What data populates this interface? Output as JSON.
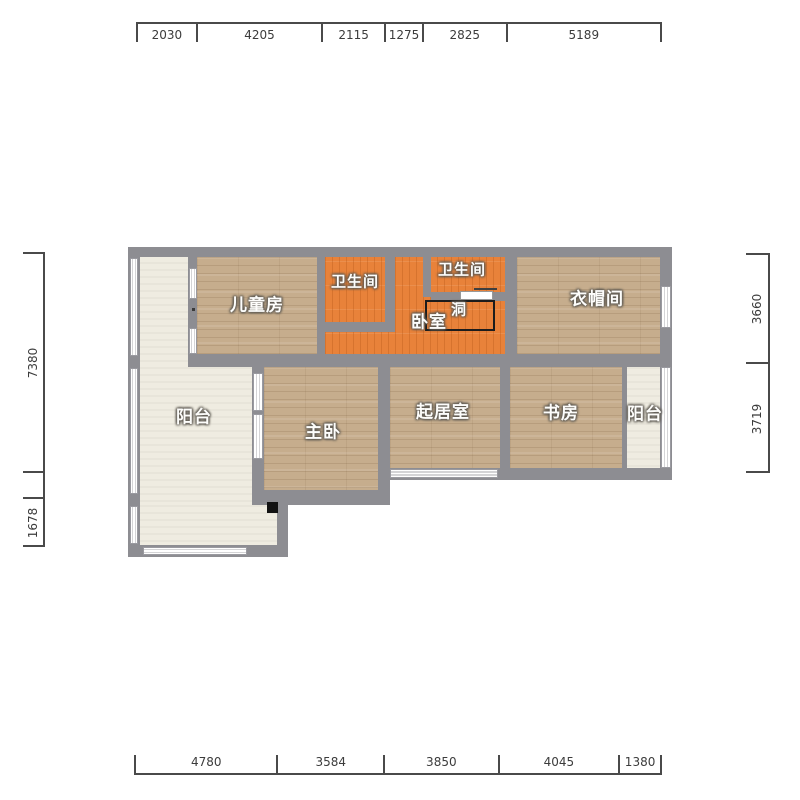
{
  "plan": {
    "rooms": {
      "children_room": "儿童房",
      "bathroom_left": "卫生间",
      "bathroom_right": "卫生间",
      "bedroom": "卧室",
      "hole": "洞",
      "cloakroom": "衣帽间",
      "balcony_left": "阳台",
      "master_bedroom": "主卧",
      "living_room": "起居室",
      "study": "书房",
      "balcony_right": "阳台"
    }
  },
  "dims": {
    "top": [
      "2030",
      "4205",
      "2115",
      "1275",
      "2825",
      "5189"
    ],
    "bottom": [
      "4780",
      "3584",
      "3850",
      "4045",
      "1380"
    ],
    "left": [
      "7380",
      "1678"
    ],
    "right": [
      "3660",
      "3719"
    ]
  },
  "colors": {
    "wall": "#8d8d92",
    "wood_floor": "#c6ad8d",
    "wet_area_floor": "#e8823a",
    "balcony_floor": "#efece1",
    "dimension_text": "#3c3c3c"
  }
}
